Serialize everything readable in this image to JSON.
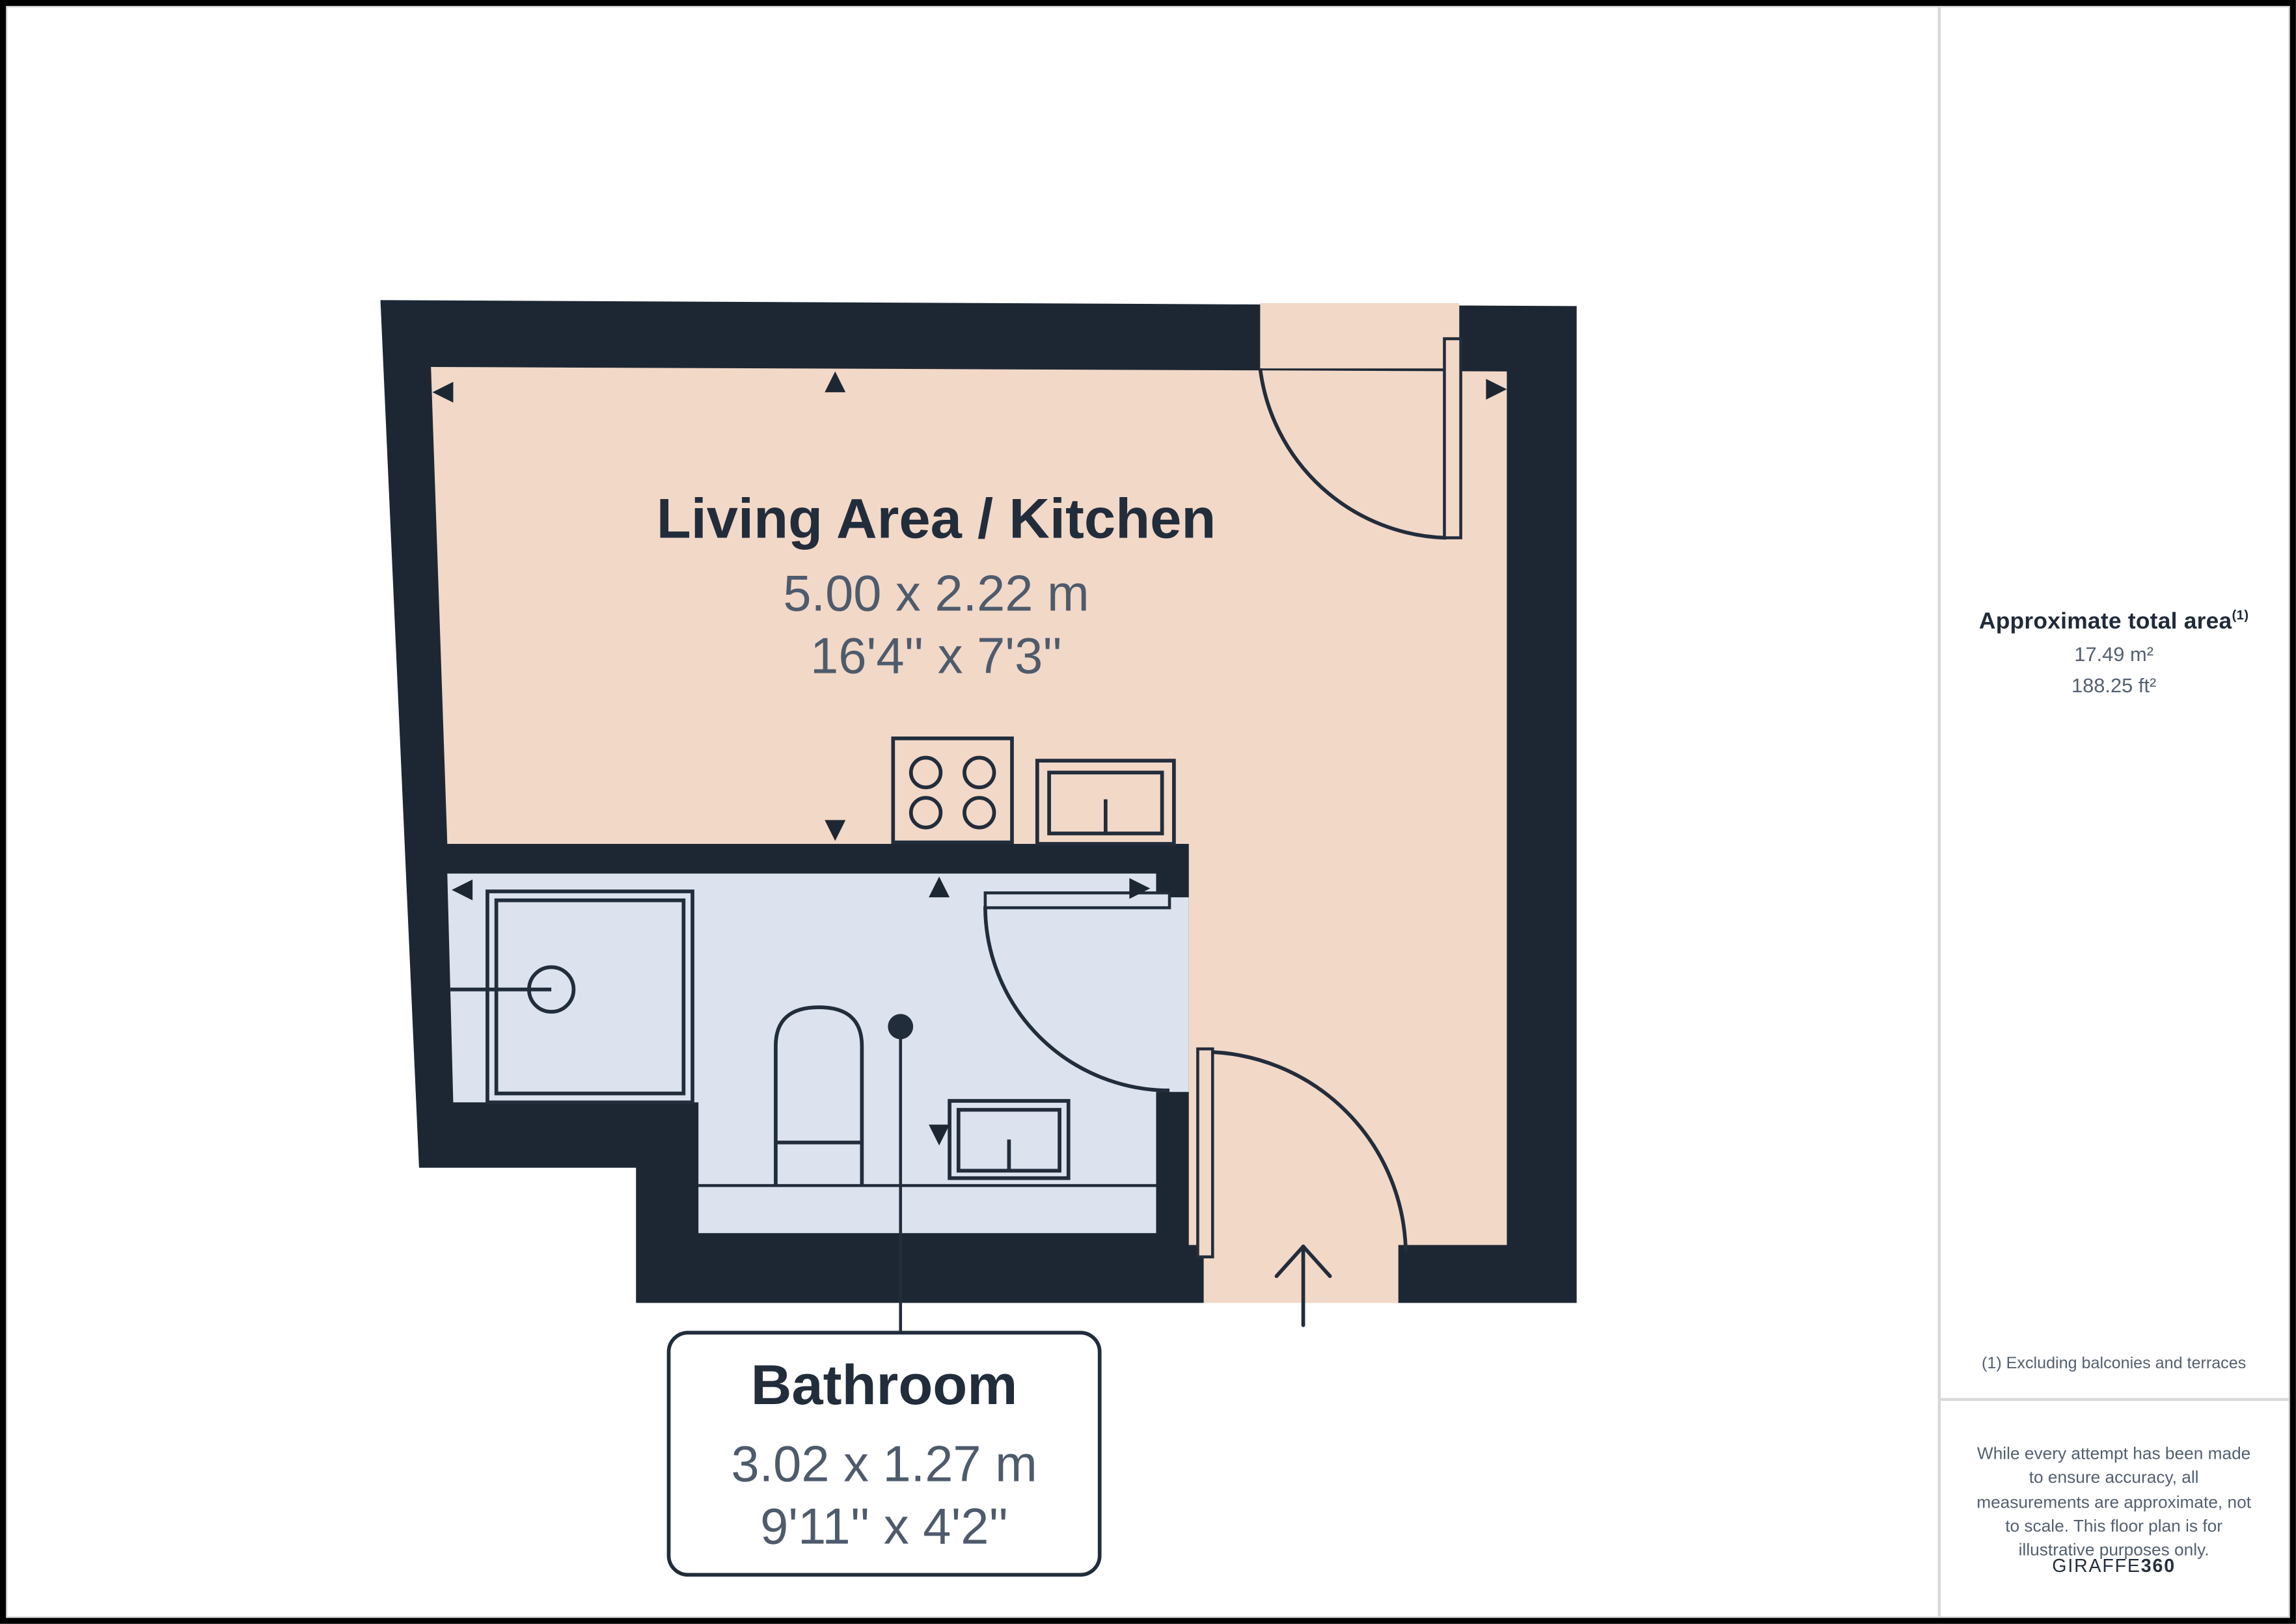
{
  "palette": {
    "wall": "#1d2734",
    "living_floor": "#f2d8c7",
    "bathroom_floor": "#dce2ee",
    "text_dark": "#222d3c",
    "dim_text": "#4d5b6c",
    "sidebar_text": "#54606f",
    "divider": "#d8d8d8",
    "frame": "#000000",
    "callout_bg": "#ffffff"
  },
  "plan": {
    "rooms": {
      "living_kitchen": {
        "name": "Living Area / Kitchen",
        "size_metric": "5.00 x 2.22 m",
        "size_imperial": "16'4'' x 7'3''"
      },
      "bathroom": {
        "name": "Bathroom",
        "size_metric": "3.02 x 1.27 m",
        "size_imperial": "9'11'' x 4'2''"
      }
    },
    "fixtures": [
      "hob-icon",
      "kitchen-sink-icon",
      "shower-icon",
      "toilet-icon",
      "washbasin-icon"
    ],
    "door_count": 3,
    "entry_arrow_direction": "up"
  },
  "sidebar": {
    "title": "Approximate total area",
    "title_sup": "(1)",
    "area_m2": "17.49 m²",
    "area_ft2": "188.25 ft²",
    "footnote": "(1) Excluding balconies and terraces",
    "disclaimer": "While every attempt has been made to ensure accuracy, all measurements are approximate, not to scale. This floor plan is for illustrative purposes only.",
    "brand_regular": "GIRAFFE",
    "brand_bold": "360"
  }
}
